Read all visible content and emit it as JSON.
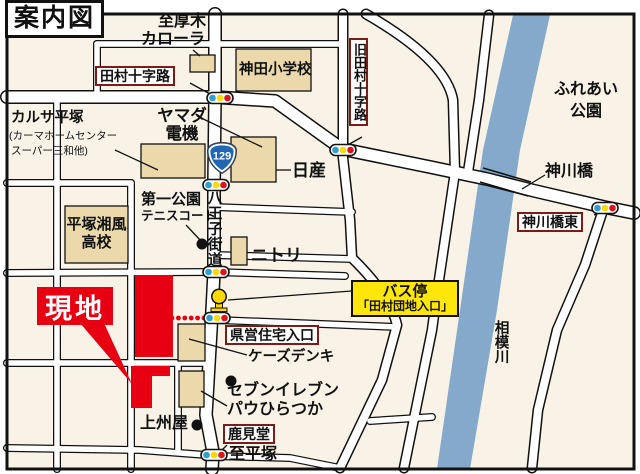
{
  "title": "案内図",
  "destination_label": "現地",
  "route_badge": "129",
  "roads": {
    "hachioji_kaido": "八王子街道",
    "to_atsugi": "至厚木",
    "to_hiratsuka": "至平塚"
  },
  "boxed_labels": {
    "tamura_crossing": "田村十字路",
    "kyu_tamura_crossing": "旧田村十字路",
    "kamikawabashi_higashi": "神川橋東",
    "kenei_jutaku_iriguchi": "県営住宅入口",
    "shikamido": "鹿見堂"
  },
  "bus_stop": {
    "line1": "バス停",
    "line2": "「田村団地入口」"
  },
  "places": {
    "corolla": "カローラ",
    "kanda_elementary": "神田小学校",
    "karusa_hiratsuka": "カルサ平塚",
    "karusa_sub1": "(カーマホームセンター",
    "karusa_sub2": "スーパー三和他)",
    "yamada_line1": "ヤマダ",
    "yamada_line2": "電機",
    "nissan": "日産",
    "daiichi_park": "第一公園",
    "tennis_court": "テニスコート",
    "nitori": "ニトリ",
    "shofu_line1": "平塚湘風",
    "shofu_line2": "高校",
    "fureai_line1": "ふれあい",
    "fureai_line2": "公園",
    "kamikawabashi": "神川橋",
    "sagami_river": "相模川",
    "ks_denki": "ケーズデンキ",
    "seven_eleven": "セブンイレブン",
    "pau_hiratsuka": "パウひらつか",
    "joshuya": "上州屋"
  },
  "colors": {
    "map_background": "#f8f3e6",
    "river_blue": "#84a9cb",
    "building_beige": "#ecd9ab",
    "destination_red": "#e60012",
    "label_border_maroon": "#7b1d15",
    "bus_label_yellow": "#ffe60a",
    "route_badge_blue": "#2166b3",
    "signal_blue": "#2f9fd0",
    "signal_yellow": "#ffd900",
    "signal_red": "#e0131b"
  }
}
